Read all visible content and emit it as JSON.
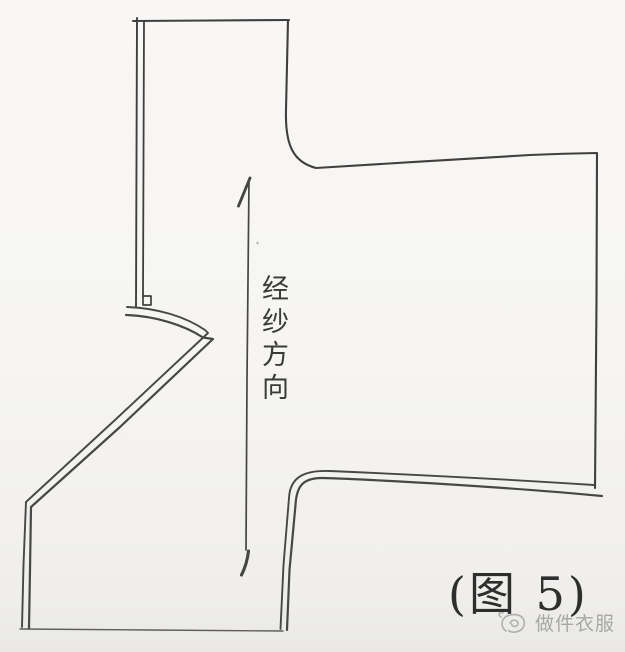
{
  "figure": {
    "grain_direction_label": "经纱方向",
    "caption": "(图 5)",
    "watermark_text": "做件衣服"
  },
  "drawing": {
    "type": "hand-drawn sewing pattern piece outline (kimono-sleeve bodice), double seam lines on left and bottom edges, small notch square at sleeve fold, vertical double-headed grain arrow"
  },
  "colors": {
    "background": "#f6f5f2",
    "outline": "#3f3f3f",
    "seam_line": "#474747",
    "hem_line": "#5d5d5d",
    "arrow": "#454545",
    "label_text": "#3a3a3a",
    "caption_text": "#2e2e2e",
    "watermark": "#9c9c9c"
  },
  "icons": {
    "watermark_logo": "scribble-snail-logo-icon"
  }
}
